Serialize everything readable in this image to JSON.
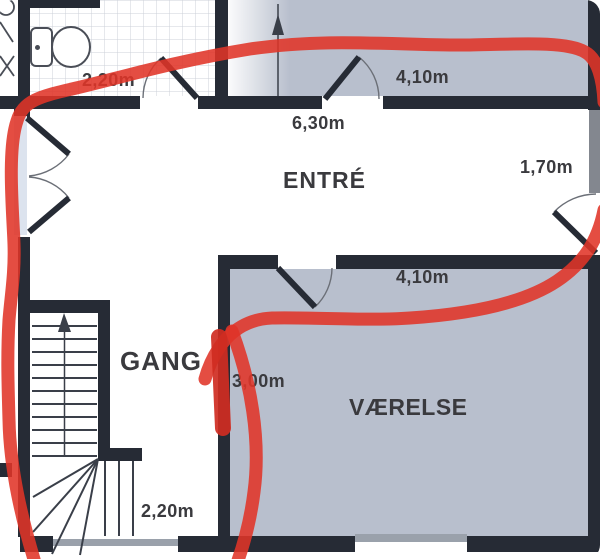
{
  "plan": {
    "rooms": [
      {
        "label": "ENTRÉ"
      },
      {
        "label": "GANG"
      },
      {
        "label": "VÆRELSE"
      }
    ],
    "dimensions": {
      "bathroom_width": "2,20m",
      "top_room_width": "4,10m",
      "entre_width": "6,30m",
      "right_door_width": "1,70m",
      "vaerelse_width": "4,10m",
      "gang_depth": "3,00m",
      "stair_width": "2,20m"
    },
    "colors": {
      "wall": "#262b35",
      "wall-muted": "#83878f",
      "room-fill": "#b8bfcd",
      "glass": "#dce3ee",
      "window-gray": "#9aa1ab",
      "tile-line": "#ccd1d9",
      "line": "#3a3f49",
      "label-text": "#3a3a3e",
      "marker-red": "#e03428",
      "marker-red-dark": "#cf2d22"
    }
  }
}
